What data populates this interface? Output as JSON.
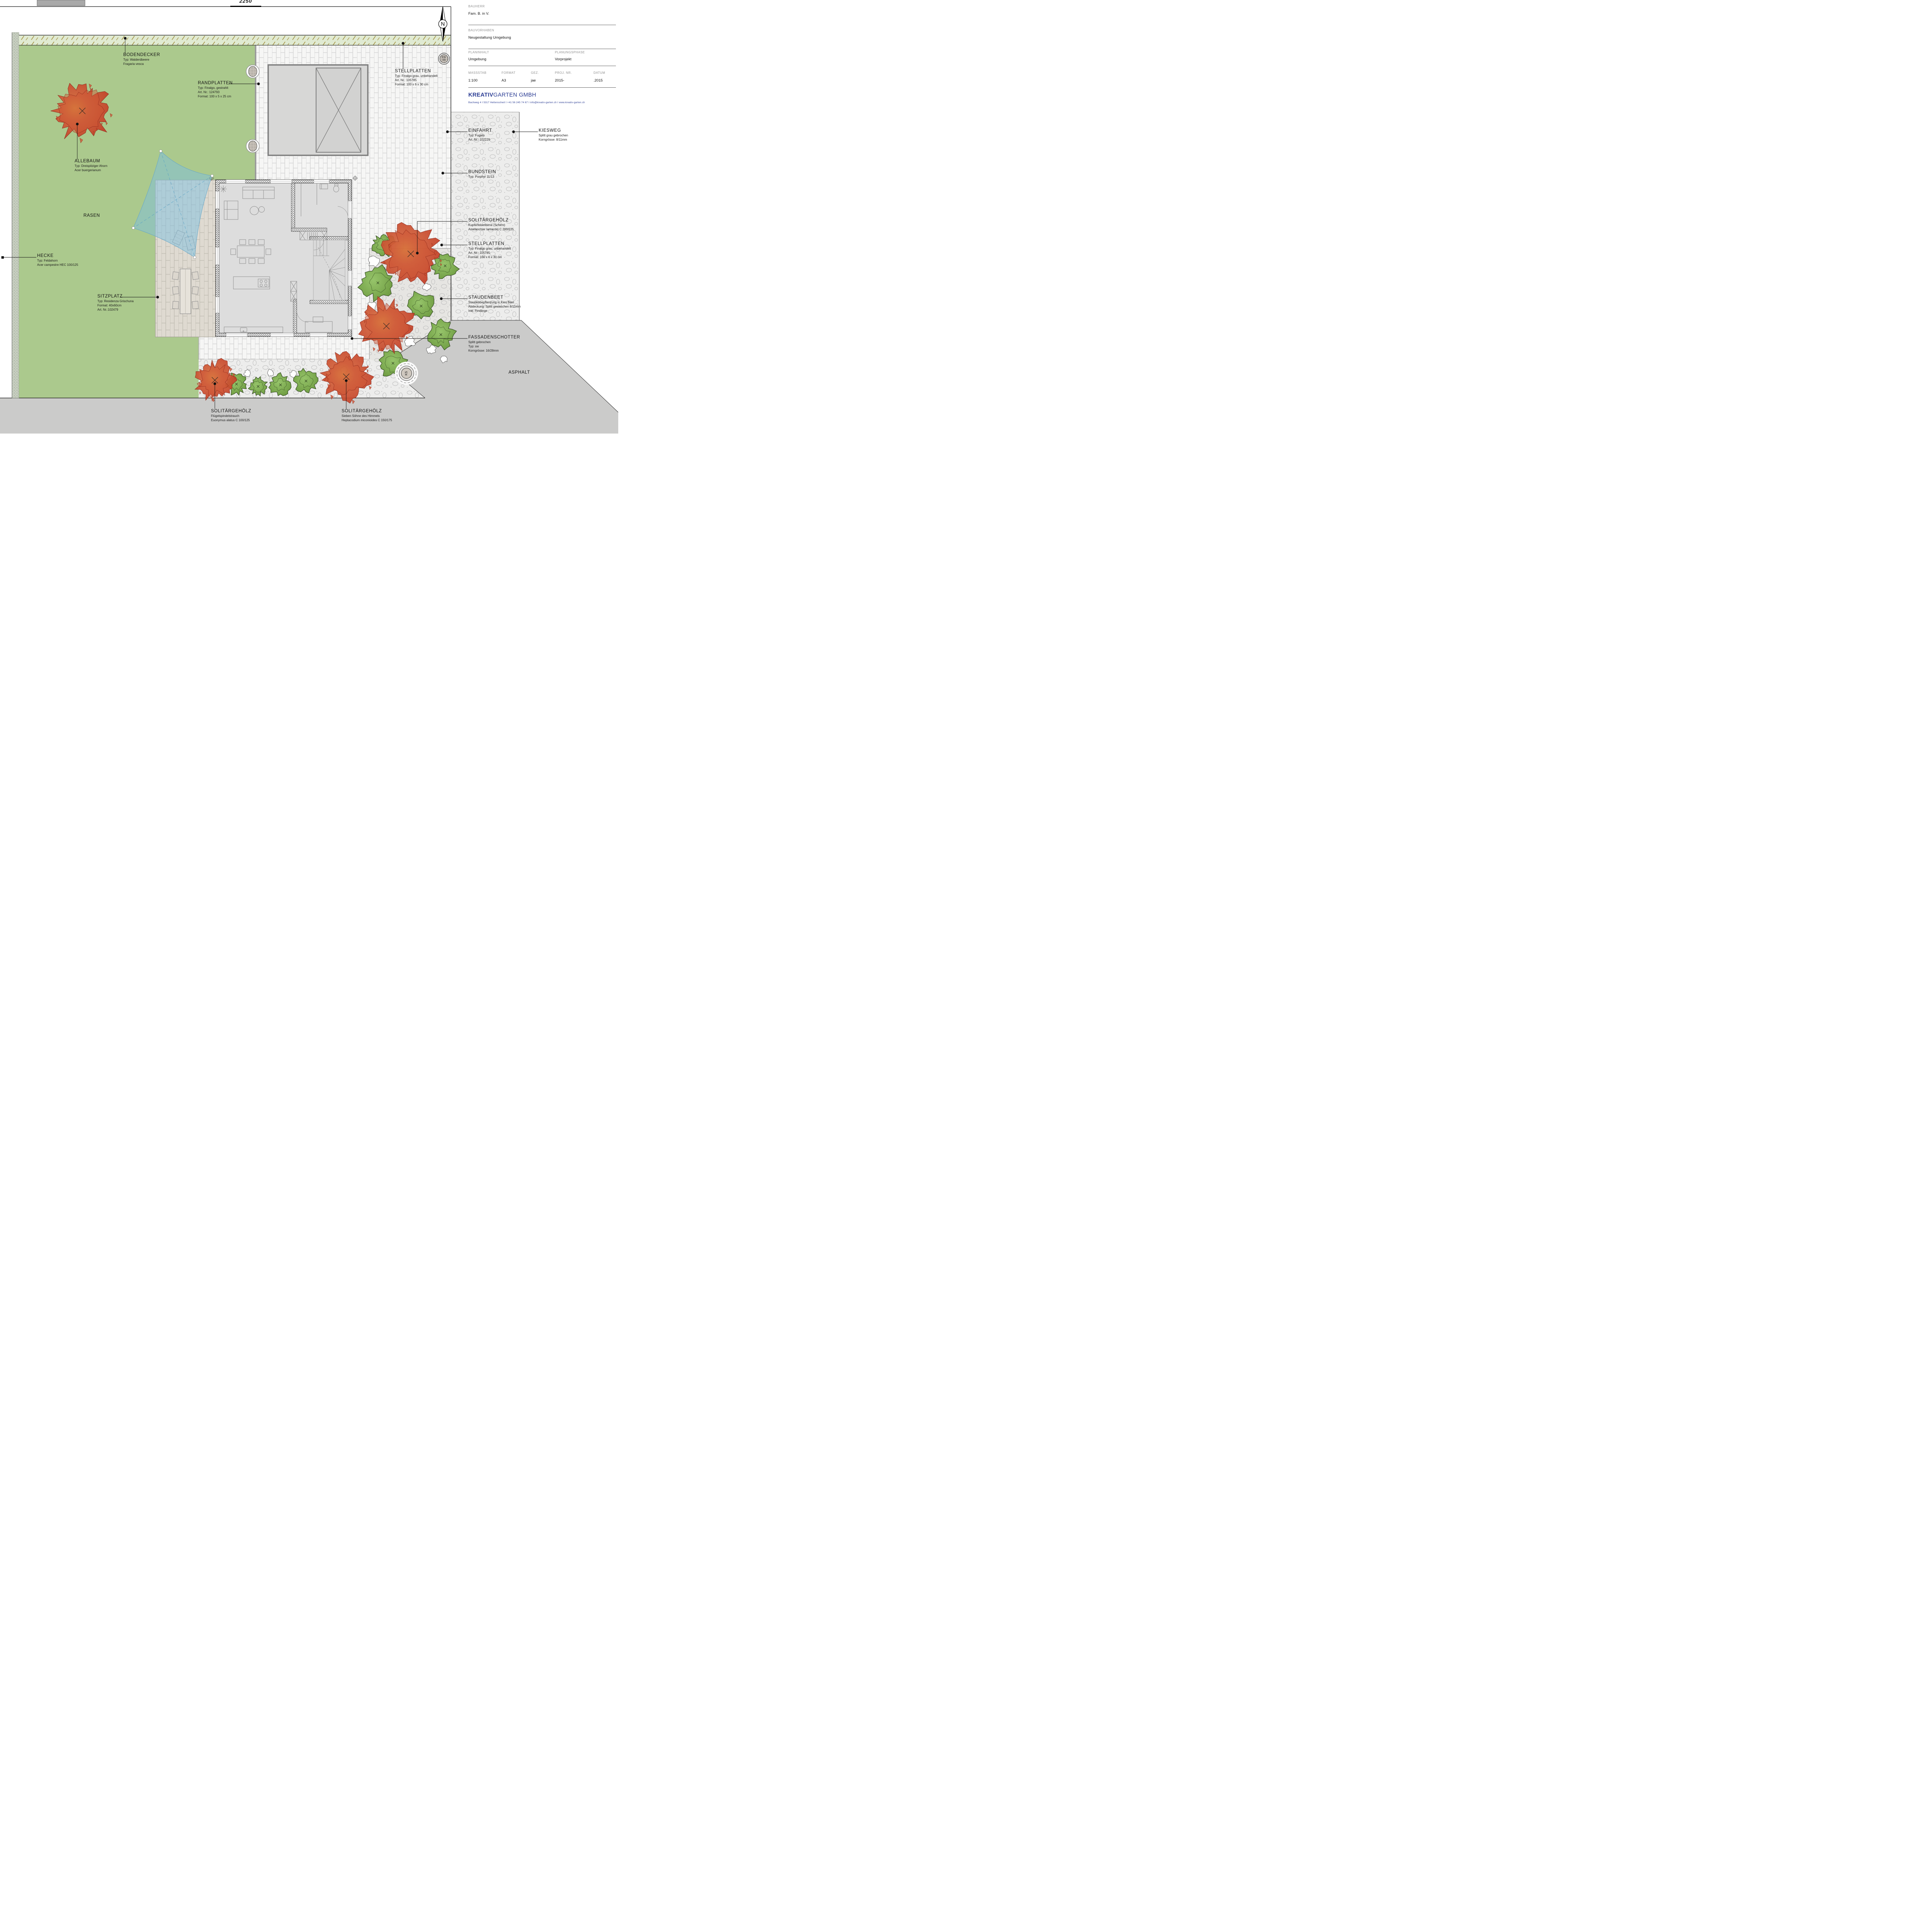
{
  "plan": {
    "top_number": "2250",
    "north_label": "N",
    "markers": {
      "es_ss": "ES/SS",
      "ks": "KS"
    }
  },
  "annotations": [
    {
      "id": "bodendecker",
      "title": "BODENDECKER",
      "lines": [
        "Typ: Walderdbeere",
        "Fragaria vesca"
      ]
    },
    {
      "id": "randplatten",
      "title": "RANDPLATTEN",
      "lines": [
        "Typ: Finalgo, gestrahlt",
        "Art. Nr.: 124793",
        "Format: 100 x 5 x 25 cm"
      ]
    },
    {
      "id": "stellplatten-nord",
      "title": "STELLPLATTEN",
      "lines": [
        "Typ: Finalgo grau, unbehandelt",
        "Art. Nr.: 105785",
        "Format: 100 x 6 x 30 cm"
      ]
    },
    {
      "id": "allebaum",
      "title": "ALLEBAUM",
      "lines": [
        "Typ: Dreispitziger Ahorn",
        "Acer buergerianum"
      ]
    },
    {
      "id": "rasen",
      "title": "RASEN",
      "lines": []
    },
    {
      "id": "hecke",
      "title": "HECKE",
      "lines": [
        "Typ: Feldahorn",
        "Acer campestre HEC 100/125"
      ]
    },
    {
      "id": "sitzplatz",
      "title": "SITZPLATZ",
      "lines": [
        "Typ: Residenza Grischuna",
        "Format: 40x60cm",
        "Art. Nr.:102479"
      ]
    },
    {
      "id": "einfahrt",
      "title": "EINFAHRT",
      "lines": [
        "Typ: Fugato",
        "Art. Nr.: 102229"
      ]
    },
    {
      "id": "kiesweg",
      "title": "KIESWEG",
      "lines": [
        "Splitt grau gebrochen",
        "Korngrösse: 8/11mm"
      ]
    },
    {
      "id": "bundstein",
      "title": "BUNDSTEIN",
      "lines": [
        "Typ: Porphyr 11/13"
      ]
    },
    {
      "id": "solitaergehoelz-amelanchier",
      "title": "SOLITÄRGEHÖLZ",
      "lines": [
        "Kupferfelsenbirne (Schirm)",
        "Amelanchier lamarckii C 200/225"
      ]
    },
    {
      "id": "stellplatten-ost",
      "title": "STELLPLATTEN",
      "lines": [
        "Typ: Finalgo grau, unbehandelt",
        "Art. Nr.: 105785",
        "Format: 100 x 6 x 30 cm"
      ]
    },
    {
      "id": "staudenbeet",
      "title": "STAUDENBEET",
      "lines": [
        "Staudenbepflanzung in Kies Beet",
        "Abdeckung: Splitt gewaschen 8/11mm",
        "Inkl. Findlinge"
      ]
    },
    {
      "id": "fassadenschotter",
      "title": "FASSADENSCHOTTER",
      "lines": [
        "Splitt gebrochen",
        "Typ: sw",
        "Korngrösse: 16/28mm"
      ]
    },
    {
      "id": "asphalt",
      "title": "ASPHALT",
      "lines": []
    },
    {
      "id": "solitaergehoelz-euonymus",
      "title": "SOLITÄRGEHÖLZ",
      "lines": [
        "Flügelspindelstrauch",
        "Euonymus alatus C 100/125"
      ]
    },
    {
      "id": "solitaergehoelz-heptacodium",
      "title": "SOLITÄRGEHÖLZ",
      "lines": [
        "Sieben Söhne des Himmels",
        "Heptacodium miconioides C 150/175"
      ]
    }
  ],
  "titleblock": {
    "bauherr_label": "BAUHERR",
    "bauherr": "Fam. B. in V.",
    "bauvorhaben_label": "BAUVORHABEN",
    "bauvorhaben": "Neugestaltung Umgebung",
    "planinhalt_label": "PLANINHALT",
    "planinhalt": "Umgebung",
    "planungsphase_label": "PLANUNGSPHASE",
    "planungsphase": "Vorprojekt",
    "massstab_label": "MASSSTAB",
    "massstab": "1:100",
    "format_label": "FORMAT",
    "format": "A3",
    "gez_label": "GEZ.",
    "gez": "jae",
    "projnr_label": "PROJ. NR.",
    "projnr": "2015-",
    "datum_label": "DATUM",
    "datum": ".2015",
    "company_bold": "KREATIV",
    "company_regular": "GARTEN",
    "company_suffix": " GMBH",
    "contact": "Bachweg 4   I   5317 Hettenschwil   I   +41 56 245 74 67   I   info@kreativ-garten.ch   I   www.kreativ-garten.ch"
  },
  "colors": {
    "lawn": "#abc98d",
    "bodendecker_band": "#e0ead2",
    "hedge_band": "#c6cdbf",
    "paving": "#f6f6f5",
    "terrace": "#dfdad1",
    "gravel": "#ededec",
    "bed": "#e6e5e2",
    "asphalt": "#cbcbca",
    "house_floor": "#dddddd",
    "garage_floor": "#d7d7d6",
    "tree_red": "#cf5534",
    "tree_red_dark": "#8c2418",
    "bush_green": "#7fae53",
    "bush_green_dark": "#2c431c",
    "sail_blue": "#7dc0e0",
    "brand_blue": "#2b3d94"
  }
}
